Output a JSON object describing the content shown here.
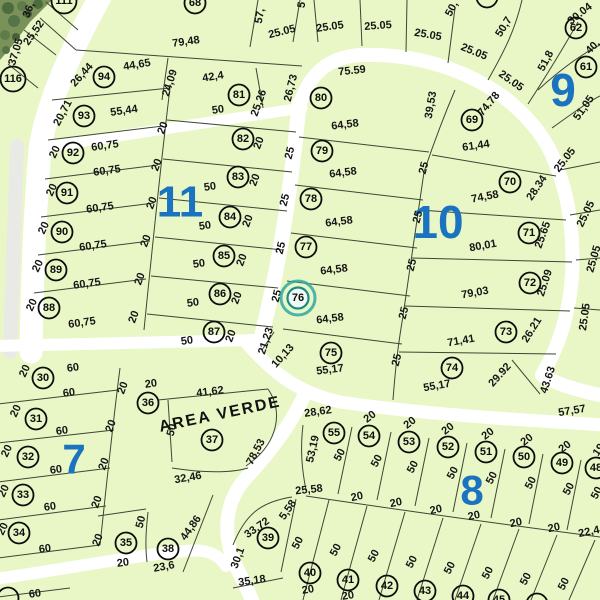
{
  "map": {
    "colors": {
      "parcel_fill": "#e9f6c6",
      "road": "#ffffff",
      "road_gray": "#e9eae6",
      "boundary_line": "#3c4733",
      "block_label": "#1a73c0",
      "highlight": "#2fa8a3",
      "highlight_fill": "#effaf6",
      "satellite_base": "#7a9259"
    },
    "area_label": {
      "text": "AREA VERDE",
      "x": 221,
      "y": 419,
      "rot": -12
    },
    "highlighted_lot": "76",
    "block_labels": [
      {
        "text": "9",
        "x": 563,
        "y": 90,
        "size": 46
      },
      {
        "text": "10",
        "x": 438,
        "y": 222,
        "size": 46
      },
      {
        "text": "11",
        "x": 180,
        "y": 202,
        "size": 44
      },
      {
        "text": "7",
        "x": 74,
        "y": 459,
        "size": 42
      },
      {
        "text": "8",
        "x": 472,
        "y": 490,
        "size": 42
      }
    ],
    "lots": [
      [
        "111",
        64,
        1
      ],
      [
        "116",
        13,
        79
      ],
      [
        "94",
        104,
        77
      ],
      [
        "93",
        84,
        116
      ],
      [
        "92",
        73,
        153
      ],
      [
        "91",
        67,
        193
      ],
      [
        "90",
        62,
        232
      ],
      [
        "89",
        56,
        270
      ],
      [
        "88",
        49,
        308
      ],
      [
        "81",
        239,
        95
      ],
      [
        "82",
        243,
        139
      ],
      [
        "83",
        238,
        177
      ],
      [
        "84",
        230,
        217
      ],
      [
        "85",
        224,
        256
      ],
      [
        "86",
        220,
        294
      ],
      [
        "87",
        214,
        332
      ],
      [
        "68",
        195,
        3
      ],
      [
        "",
        487,
        -3
      ],
      [
        "80",
        321,
        98
      ],
      [
        "79",
        322,
        151
      ],
      [
        "78",
        311,
        199
      ],
      [
        "77",
        306,
        247
      ],
      [
        "76",
        298,
        298
      ],
      [
        "75",
        331,
        353
      ],
      [
        "69",
        472,
        120
      ],
      [
        "70",
        510,
        182
      ],
      [
        "71",
        529,
        233
      ],
      [
        "72",
        530,
        283
      ],
      [
        "73",
        506,
        332
      ],
      [
        "74",
        452,
        368
      ],
      [
        "62",
        576,
        28
      ],
      [
        "61",
        586,
        67
      ],
      [
        "30",
        43,
        378
      ],
      [
        "31",
        36,
        419
      ],
      [
        "32",
        28,
        457
      ],
      [
        "33",
        23,
        495
      ],
      [
        "34",
        19,
        533
      ],
      [
        "35",
        126,
        543
      ],
      [
        "36",
        148,
        403
      ],
      [
        "37",
        212,
        440
      ],
      [
        "38",
        168,
        549
      ],
      [
        "39",
        268,
        538
      ],
      [
        "55",
        334,
        433
      ],
      [
        "54",
        369,
        436
      ],
      [
        "53",
        409,
        442
      ],
      [
        "52",
        448,
        447
      ],
      [
        "51",
        486,
        452
      ],
      [
        "50",
        524,
        457
      ],
      [
        "49",
        562,
        463
      ],
      [
        "48",
        596,
        468
      ],
      [
        "40",
        310,
        573
      ],
      [
        "41",
        348,
        580
      ],
      [
        "42",
        387,
        586
      ],
      [
        "43",
        425,
        591
      ],
      [
        "44",
        463,
        596
      ],
      [
        "45",
        499,
        600
      ],
      [
        "",
        537,
        604
      ],
      [
        "",
        8,
        598
      ]
    ],
    "dims": [
      [
        "36,",
        29,
        10,
        -68
      ],
      [
        "25,52",
        34,
        33,
        -55
      ],
      [
        "37,05",
        16,
        52,
        -73
      ],
      [
        "79,48",
        186,
        42,
        -8
      ],
      [
        "57,",
        260,
        16,
        -80
      ],
      [
        "5",
        302,
        5,
        -80
      ],
      [
        "25.05",
        282,
        32,
        -14
      ],
      [
        "25.05",
        330,
        27,
        -8
      ],
      [
        "25.05",
        378,
        26,
        -4
      ],
      [
        "25.05",
        428,
        35,
        10
      ],
      [
        "25.05",
        474,
        52,
        22
      ],
      [
        "25.05",
        511,
        81,
        35
      ],
      [
        "50,",
        452,
        9,
        -62
      ],
      [
        "50,7",
        504,
        27,
        -58
      ],
      [
        "30.04",
        580,
        14,
        -38
      ],
      [
        "51,8",
        546,
        61,
        -62
      ],
      [
        "40,",
        593,
        47,
        -45
      ],
      [
        "51,05",
        584,
        108,
        -55
      ],
      [
        "25.05",
        565,
        160,
        -52
      ],
      [
        "25.05",
        586,
        214,
        -64
      ],
      [
        "25.05",
        594,
        259,
        -74
      ],
      [
        "25.05",
        585,
        317,
        -82
      ],
      [
        "75.59",
        352,
        71,
        -6
      ],
      [
        "26,73",
        291,
        88,
        -76
      ],
      [
        "64,58",
        345,
        125,
        -7
      ],
      [
        "64,58",
        343,
        173,
        -7
      ],
      [
        "64,58",
        339,
        222,
        -7
      ],
      [
        "64,58",
        334,
        270,
        -7
      ],
      [
        "64,58",
        330,
        319,
        -7
      ],
      [
        "55,17",
        330,
        370,
        -7
      ],
      [
        "25",
        290,
        153,
        -75
      ],
      [
        "25",
        285,
        200,
        -75
      ],
      [
        "25",
        281,
        248,
        -75
      ],
      [
        "25",
        277,
        296,
        -75
      ],
      [
        "21,23",
        266,
        341,
        -72
      ],
      [
        "10,13",
        283,
        356,
        -48
      ],
      [
        "25",
        424,
        168,
        -75
      ],
      [
        "25",
        418,
        217,
        -75
      ],
      [
        "25",
        412,
        265,
        -75
      ],
      [
        "25",
        404,
        313,
        -75
      ],
      [
        "25",
        397,
        360,
        -75
      ],
      [
        "39,53",
        431,
        105,
        -80
      ],
      [
        "74.78",
        489,
        104,
        -50
      ],
      [
        "61,44",
        476,
        146,
        -8
      ],
      [
        "74,58",
        485,
        197,
        -11
      ],
      [
        "28.34",
        537,
        188,
        -56
      ],
      [
        "80,01",
        483,
        246,
        -10
      ],
      [
        "25.65",
        543,
        235,
        -70
      ],
      [
        "79,03",
        475,
        293,
        -10
      ],
      [
        "25.09",
        545,
        283,
        -72
      ],
      [
        "71,41",
        461,
        341,
        -10
      ],
      [
        "26.21",
        532,
        330,
        -58
      ],
      [
        "55,17",
        437,
        386,
        -10
      ],
      [
        "29.92",
        500,
        375,
        -48
      ],
      [
        "43.63",
        548,
        380,
        -72
      ],
      [
        "57,57",
        572,
        411,
        -9
      ],
      [
        "26,44",
        82,
        75,
        -48
      ],
      [
        "44,65",
        137,
        65,
        -9
      ],
      [
        "24,09",
        170,
        83,
        -72
      ],
      [
        "42,4",
        213,
        77,
        -9
      ],
      [
        "25,26",
        259,
        103,
        -70
      ],
      [
        "20,71",
        63,
        113,
        -62
      ],
      [
        "55,44",
        124,
        111,
        -8
      ],
      [
        "20",
        163,
        128,
        -70
      ],
      [
        "50",
        218,
        110,
        -8
      ],
      [
        "20",
        55,
        152,
        -65
      ],
      [
        "60,75",
        105,
        146,
        -8
      ],
      [
        "60,75",
        107,
        171,
        -8
      ],
      [
        "20",
        157,
        165,
        -70
      ],
      [
        "20",
        52,
        190,
        -65
      ],
      [
        "60,75",
        100,
        208,
        -8
      ],
      [
        "20",
        152,
        203,
        -70
      ],
      [
        "20",
        44,
        228,
        -65
      ],
      [
        "60,75",
        93,
        246,
        -8
      ],
      [
        "20",
        146,
        241,
        -70
      ],
      [
        "20",
        38,
        266,
        -65
      ],
      [
        "60,75",
        87,
        284,
        -8
      ],
      [
        "20",
        140,
        279,
        -70
      ],
      [
        "20",
        32,
        305,
        -65
      ],
      [
        "60,75",
        82,
        323,
        -8
      ],
      [
        "20",
        134,
        317,
        -70
      ],
      [
        "20",
        259,
        143,
        -70
      ],
      [
        "50",
        210,
        187,
        -8
      ],
      [
        "20",
        255,
        180,
        -70
      ],
      [
        "50",
        205,
        226,
        -8
      ],
      [
        "20",
        248,
        221,
        -70
      ],
      [
        "50",
        199,
        264,
        -8
      ],
      [
        "20",
        242,
        260,
        -70
      ],
      [
        "50",
        193,
        303,
        -8
      ],
      [
        "20",
        237,
        298,
        -70
      ],
      [
        "50",
        187,
        341,
        -8
      ],
      [
        "20",
        231,
        336,
        -70
      ],
      [
        "20",
        25,
        371,
        -65
      ],
      [
        "60",
        73,
        368,
        -8
      ],
      [
        "60",
        69,
        393,
        -8
      ],
      [
        "20",
        123,
        388,
        -70
      ],
      [
        "20",
        16,
        411,
        -65
      ],
      [
        "60",
        62,
        431,
        -8
      ],
      [
        "20",
        111,
        426,
        -70
      ],
      [
        "20",
        7,
        451,
        -65
      ],
      [
        "60",
        56,
        470,
        -8
      ],
      [
        "20",
        104,
        464,
        -70
      ],
      [
        "20",
        4,
        491,
        -65
      ],
      [
        "60",
        50,
        507,
        -8
      ],
      [
        "20",
        97,
        502,
        -70
      ],
      [
        "20",
        3,
        529,
        -65
      ],
      [
        "60",
        45,
        549,
        -8
      ],
      [
        "20",
        98,
        540,
        -70
      ],
      [
        "60",
        35,
        594,
        -8
      ],
      [
        "20",
        151,
        384,
        -8
      ],
      [
        "41,62",
        210,
        392,
        -7
      ],
      [
        "50",
        172,
        430,
        -75
      ],
      [
        "32,46",
        188,
        478,
        -10
      ],
      [
        "78,53",
        256,
        452,
        -62
      ],
      [
        "50",
        141,
        522,
        -75
      ],
      [
        "20",
        123,
        563,
        -8
      ],
      [
        "44,86",
        191,
        528,
        -55
      ],
      [
        "23,6",
        164,
        567,
        -10
      ],
      [
        "33,72",
        257,
        528,
        -35
      ],
      [
        "30,1",
        238,
        558,
        -70
      ],
      [
        "35,18",
        252,
        581,
        -8
      ],
      [
        "5,58",
        288,
        510,
        -55
      ],
      [
        "28,62",
        318,
        412,
        -8
      ],
      [
        "53,19",
        313,
        449,
        -77
      ],
      [
        "25,58",
        309,
        490,
        -6
      ],
      [
        "20",
        370,
        417,
        -38
      ],
      [
        "20",
        410,
        423,
        -38
      ],
      [
        "20",
        448,
        429,
        -38
      ],
      [
        "20",
        488,
        434,
        -38
      ],
      [
        "20",
        527,
        440,
        -38
      ],
      [
        "20",
        565,
        447,
        -38
      ],
      [
        "19",
        599,
        450,
        -55
      ],
      [
        "50",
        340,
        455,
        -62
      ],
      [
        "50",
        377,
        461,
        -62
      ],
      [
        "50",
        413,
        467,
        -62
      ],
      [
        "50",
        453,
        473,
        -62
      ],
      [
        "50",
        492,
        478,
        -62
      ],
      [
        "50",
        531,
        483,
        -62
      ],
      [
        "50",
        569,
        489,
        -62
      ],
      [
        "50",
        597,
        493,
        -62
      ],
      [
        "20",
        357,
        497,
        -12
      ],
      [
        "20",
        396,
        503,
        -12
      ],
      [
        "20",
        436,
        510,
        -12
      ],
      [
        "20",
        474,
        516,
        -12
      ],
      [
        "20",
        516,
        523,
        -12
      ],
      [
        "20",
        554,
        528,
        -12
      ],
      [
        "22,4",
        589,
        532,
        -12
      ],
      [
        "50",
        298,
        543,
        -62
      ],
      [
        "50",
        336,
        550,
        -62
      ],
      [
        "50",
        374,
        556,
        -62
      ],
      [
        "50",
        412,
        562,
        -62
      ],
      [
        "50",
        450,
        568,
        -62
      ],
      [
        "50",
        488,
        573,
        -62
      ],
      [
        "50",
        526,
        579,
        -62
      ],
      [
        "50",
        564,
        584,
        -62
      ],
      [
        "20",
        308,
        590,
        -10
      ],
      [
        "20",
        348,
        596,
        -10
      ]
    ]
  }
}
